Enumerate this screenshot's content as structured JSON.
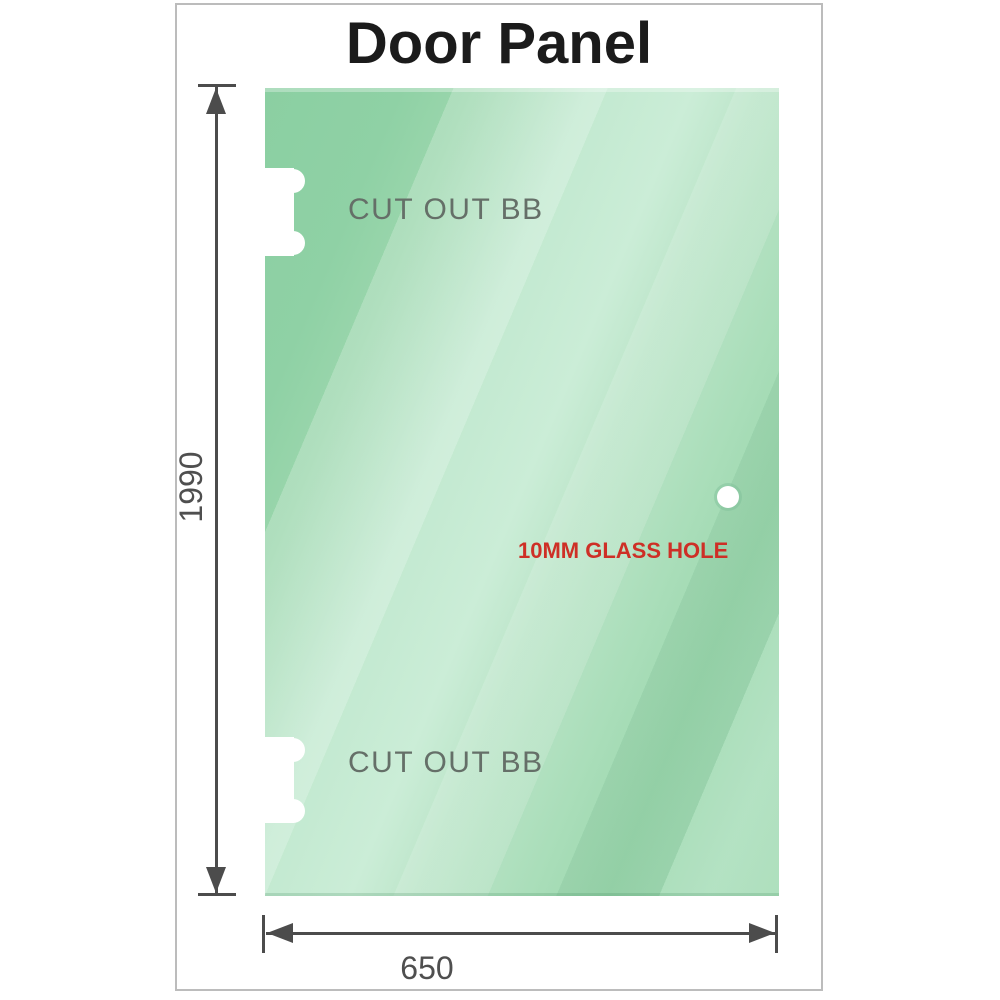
{
  "title": "Door Panel",
  "glass_panel": {
    "height_mm": "1990",
    "width_mm": "650",
    "cutout_top": {
      "label": "CUT OUT BB"
    },
    "cutout_bottom": {
      "label": "CUT OUT BB"
    },
    "glass_hole": {
      "label": "10MM GLASS HOLE"
    }
  },
  "colors": {
    "glass_base": "#8ccfa3",
    "glass_highlight": "#cbedd7",
    "dimension_line": "#4c4c4c",
    "dimension_text": "#4f4f4f",
    "cutout_text": "#656f68",
    "hole_text": "#ce2f26",
    "title_text": "#1b1b1b",
    "frame_border": "#bcbcbc"
  }
}
